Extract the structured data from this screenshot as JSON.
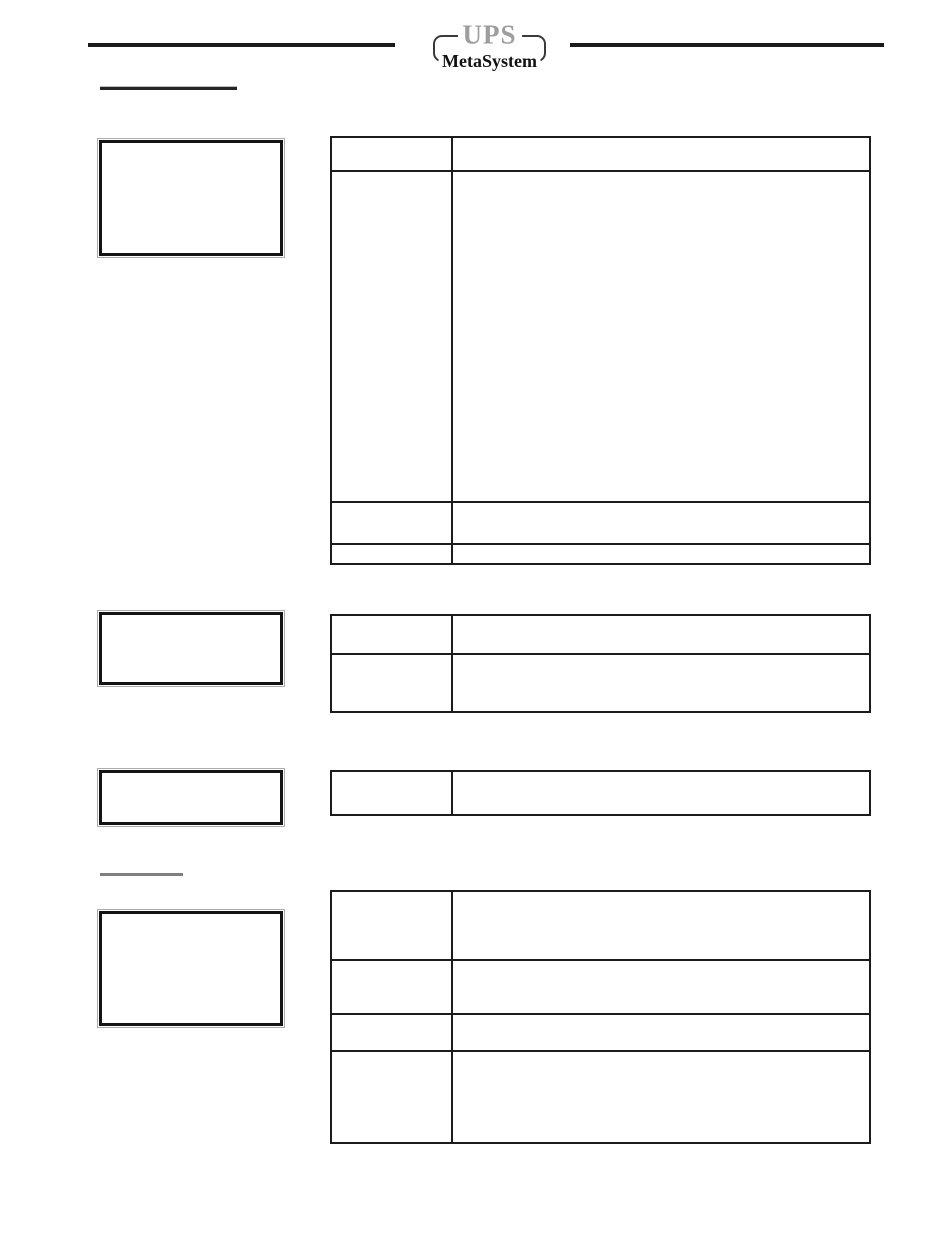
{
  "logo": {
    "brand": "UPS",
    "subbrand": "MetaSystem"
  },
  "colors": {
    "ink": "#1c1c1c",
    "rule_black": "#1a1a1a",
    "logo_brand_gray": "#9e9e9e",
    "logo_subbrand_black": "#111111",
    "box_border_black": "#141414",
    "box_outline_gray": "#ababab",
    "heading1_underline": "#242424",
    "heading2_underline": "#7f7f7f"
  },
  "headings": {
    "section1": "",
    "section2": ""
  },
  "callout_boxes": [
    {
      "text": ""
    },
    {
      "text": ""
    },
    {
      "text": ""
    },
    {
      "text": ""
    }
  ],
  "tables": [
    {
      "name": "table-1",
      "rows": [
        {
          "label": "",
          "description": ""
        },
        {
          "label": "",
          "description": ""
        },
        {
          "label": "",
          "description": ""
        },
        {
          "label": "",
          "description": ""
        }
      ]
    },
    {
      "name": "table-2",
      "rows": [
        {
          "label": "",
          "description": ""
        },
        {
          "label": "",
          "description": ""
        }
      ]
    },
    {
      "name": "table-3",
      "rows": [
        {
          "label": "",
          "description": ""
        }
      ]
    },
    {
      "name": "table-4",
      "rows": [
        {
          "label": "",
          "description": ""
        },
        {
          "label": "",
          "description": ""
        },
        {
          "label": "",
          "description": ""
        },
        {
          "label": "",
          "description": ""
        }
      ]
    }
  ]
}
